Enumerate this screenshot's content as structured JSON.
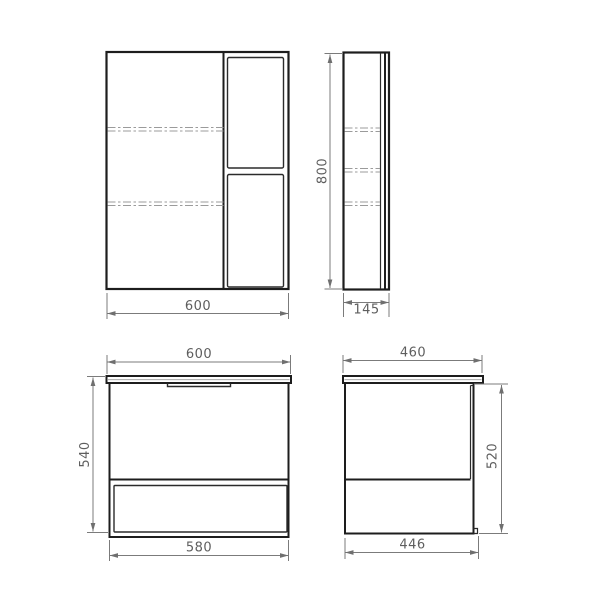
{
  "colors": {
    "background": "#ffffff",
    "object_line": "#1d1d1d",
    "hidden_line": "#9b9b9b",
    "dimension_line": "#7b7b7b",
    "dimension_text": "#5e5e5e"
  },
  "views": {
    "mirror_front": {
      "width": "600"
    },
    "mirror_side": {
      "height": "800",
      "depth": "145"
    },
    "vanity_front": {
      "width": "600",
      "height": "540",
      "bottom_width": "580"
    },
    "vanity_side": {
      "depth": "460",
      "height": "520",
      "bottom_depth": "446"
    }
  }
}
